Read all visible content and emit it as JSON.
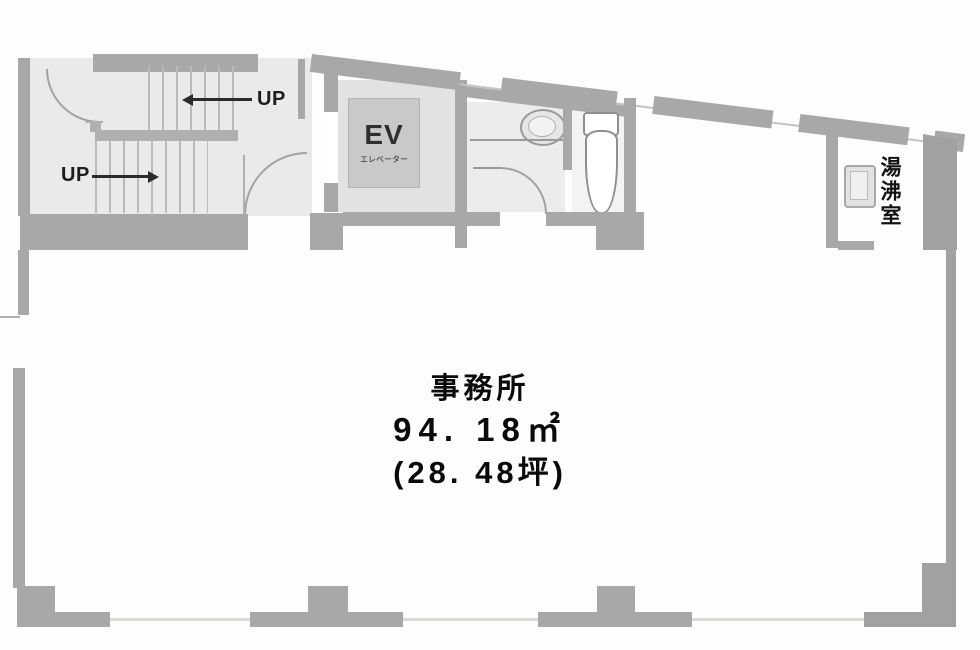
{
  "plan": {
    "stairwell": {
      "up_labels": [
        "UP",
        "UP"
      ]
    },
    "elevator": {
      "label": "EV",
      "sublabel": "エレベーター"
    },
    "kitchenette": {
      "label": "湯沸室"
    },
    "office": {
      "label": "事務所",
      "area_sqm": "94. 18㎡",
      "area_tsubo": "(28. 48坪)"
    }
  },
  "colors": {
    "wall": "#a8a8a6",
    "wall_dark": "#a0a29f",
    "floor": "#eaeae8",
    "elevator_cab": "#c9c9c7",
    "text": "#0a0a0a"
  }
}
